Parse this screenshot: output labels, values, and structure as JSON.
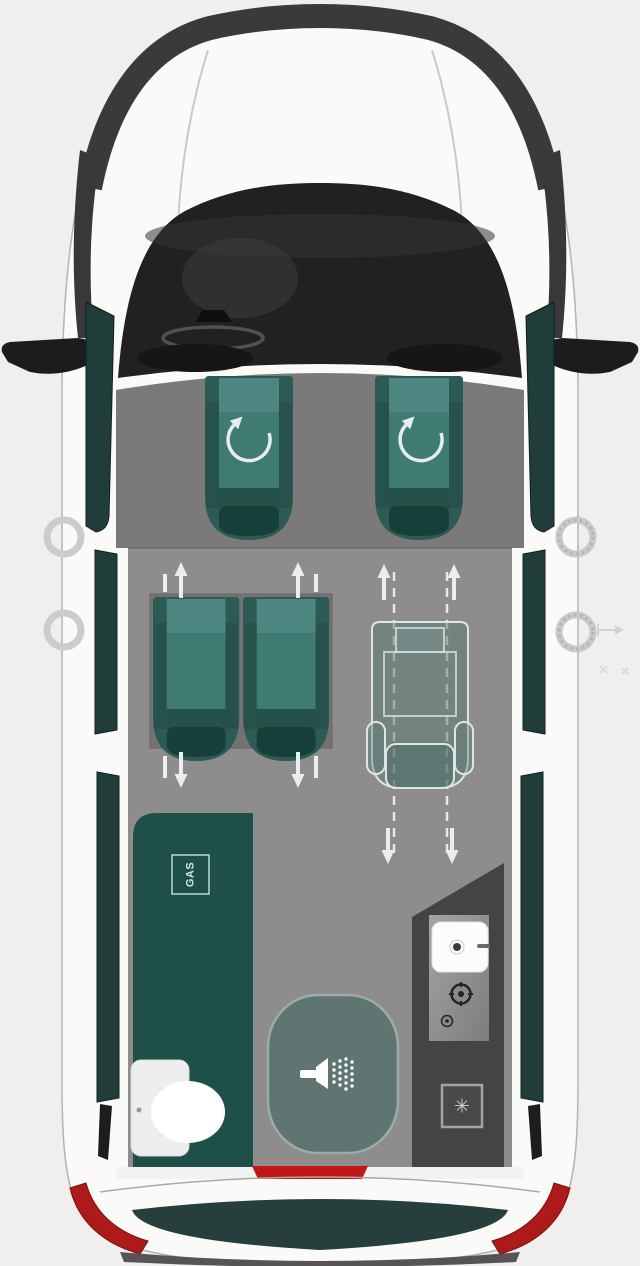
{
  "labels": {
    "gas": "GAS"
  },
  "icons": {
    "heater_glyph": "✳"
  },
  "colors": {
    "background": "#f0efed",
    "body_white": "#fafaf8",
    "roof_band": "#3a3a3a",
    "cab_dark": "#212121",
    "cab_floor": "#7b797a",
    "main_floor": "#8e8c8d",
    "seat_teal": "#3f7a73",
    "seat_teal_dark": "#163f39",
    "kitchen_teal": "#1e4f48",
    "shower_fill": "#5e7572",
    "utility_dark": "#454344",
    "window_teal": "#213d3a",
    "tail_light_red": "#ad1a1a",
    "arrow_white": "#e9efed"
  }
}
